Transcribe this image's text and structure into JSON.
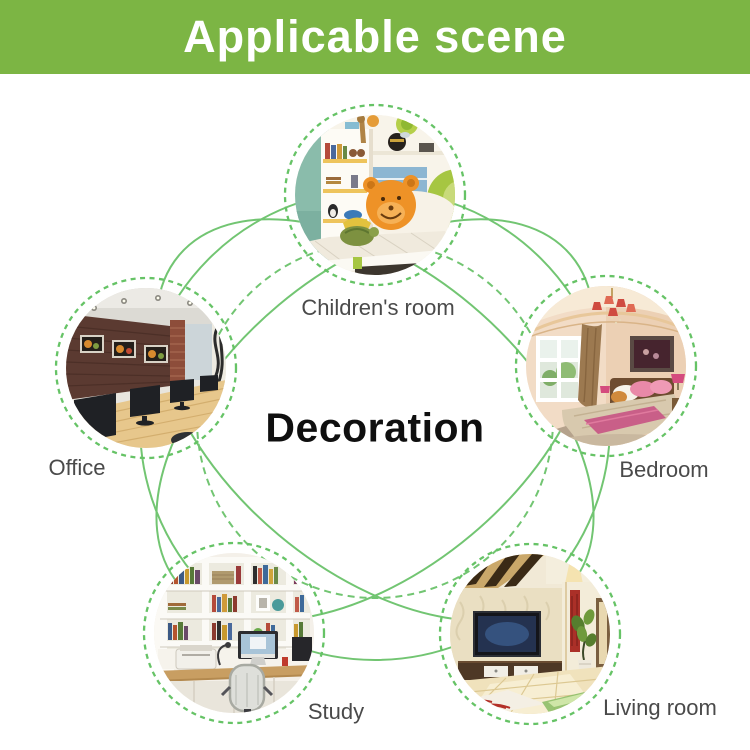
{
  "banner": {
    "title": "Applicable scene"
  },
  "center_label": "Decoration",
  "scenes": [
    {
      "label": "Children's room"
    },
    {
      "label": "Office"
    },
    {
      "label": "Bedroom"
    },
    {
      "label": "Study"
    },
    {
      "label": "Living room"
    }
  ],
  "colors": {
    "banner_green": "#7cb544",
    "banner_text": "#ffffff",
    "arc_green": "#72c572",
    "ring_green": "#66c366",
    "label_gray": "#4a4a4a",
    "center_text": "#0f0f0f"
  }
}
